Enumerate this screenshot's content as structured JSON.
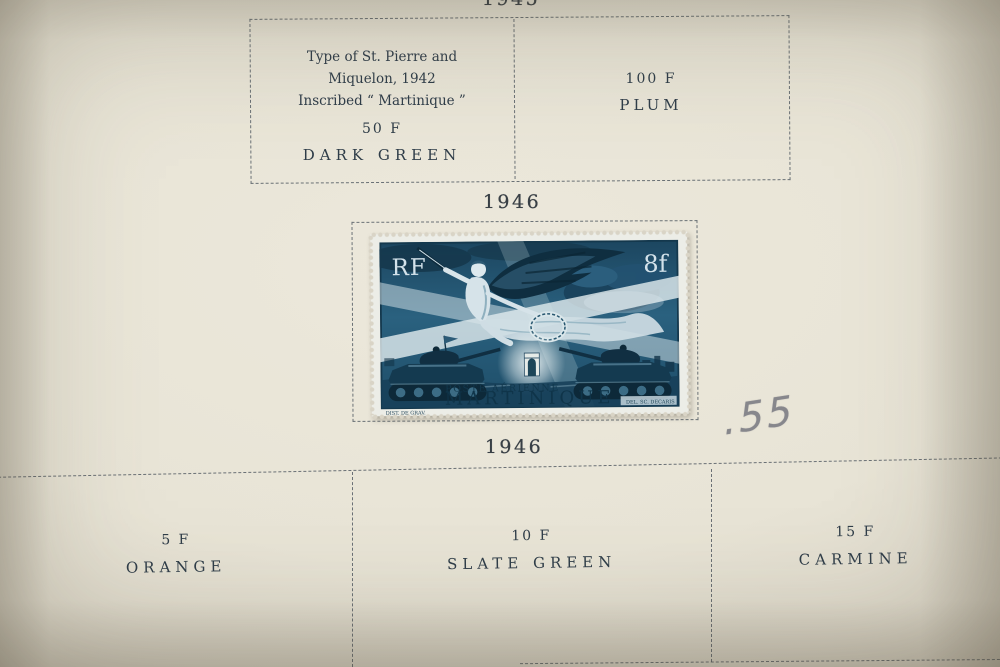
{
  "colors": {
    "paper": "#eae6d8",
    "letterpress_ink": "#2f3d49",
    "heading_ink": "#383f45",
    "rule_ink": "#4d5861",
    "stamp_ink_blue": "#27607e",
    "stamp_paper": "#ecede7",
    "pencil_gray": "#8d8d91"
  },
  "album_page": {
    "top_year_heading": "1945",
    "upper_grid": {
      "left_cell": {
        "description_lines": [
          "Type of St. Pierre and",
          "Miquelon, 1942",
          "Inscribed “ Martinique ”"
        ],
        "denomination": "50 F",
        "color_name": "DARK GREEN"
      },
      "right_cell": {
        "denomination": "100 F",
        "color_name": "PLUM"
      }
    },
    "middle_year_heading": "1946",
    "pencil_note": ".55",
    "lower_year_heading": "1946",
    "lower_grid": {
      "cells": [
        {
          "denomination": "5 F",
          "color_name": "ORANGE"
        },
        {
          "denomination": "10 F",
          "color_name": "SLATE GREEN"
        },
        {
          "denomination": "15 F",
          "color_name": "CARMINE"
        }
      ]
    }
  },
  "stamp": {
    "country_letters": "RF",
    "denomination": "8f",
    "service": "POSTE AÉRIENNE",
    "territory": "MARTINIQUE",
    "credit_left": "DIST. DE GRAV.",
    "credit_right": "DEL. SC. DECARIS"
  }
}
